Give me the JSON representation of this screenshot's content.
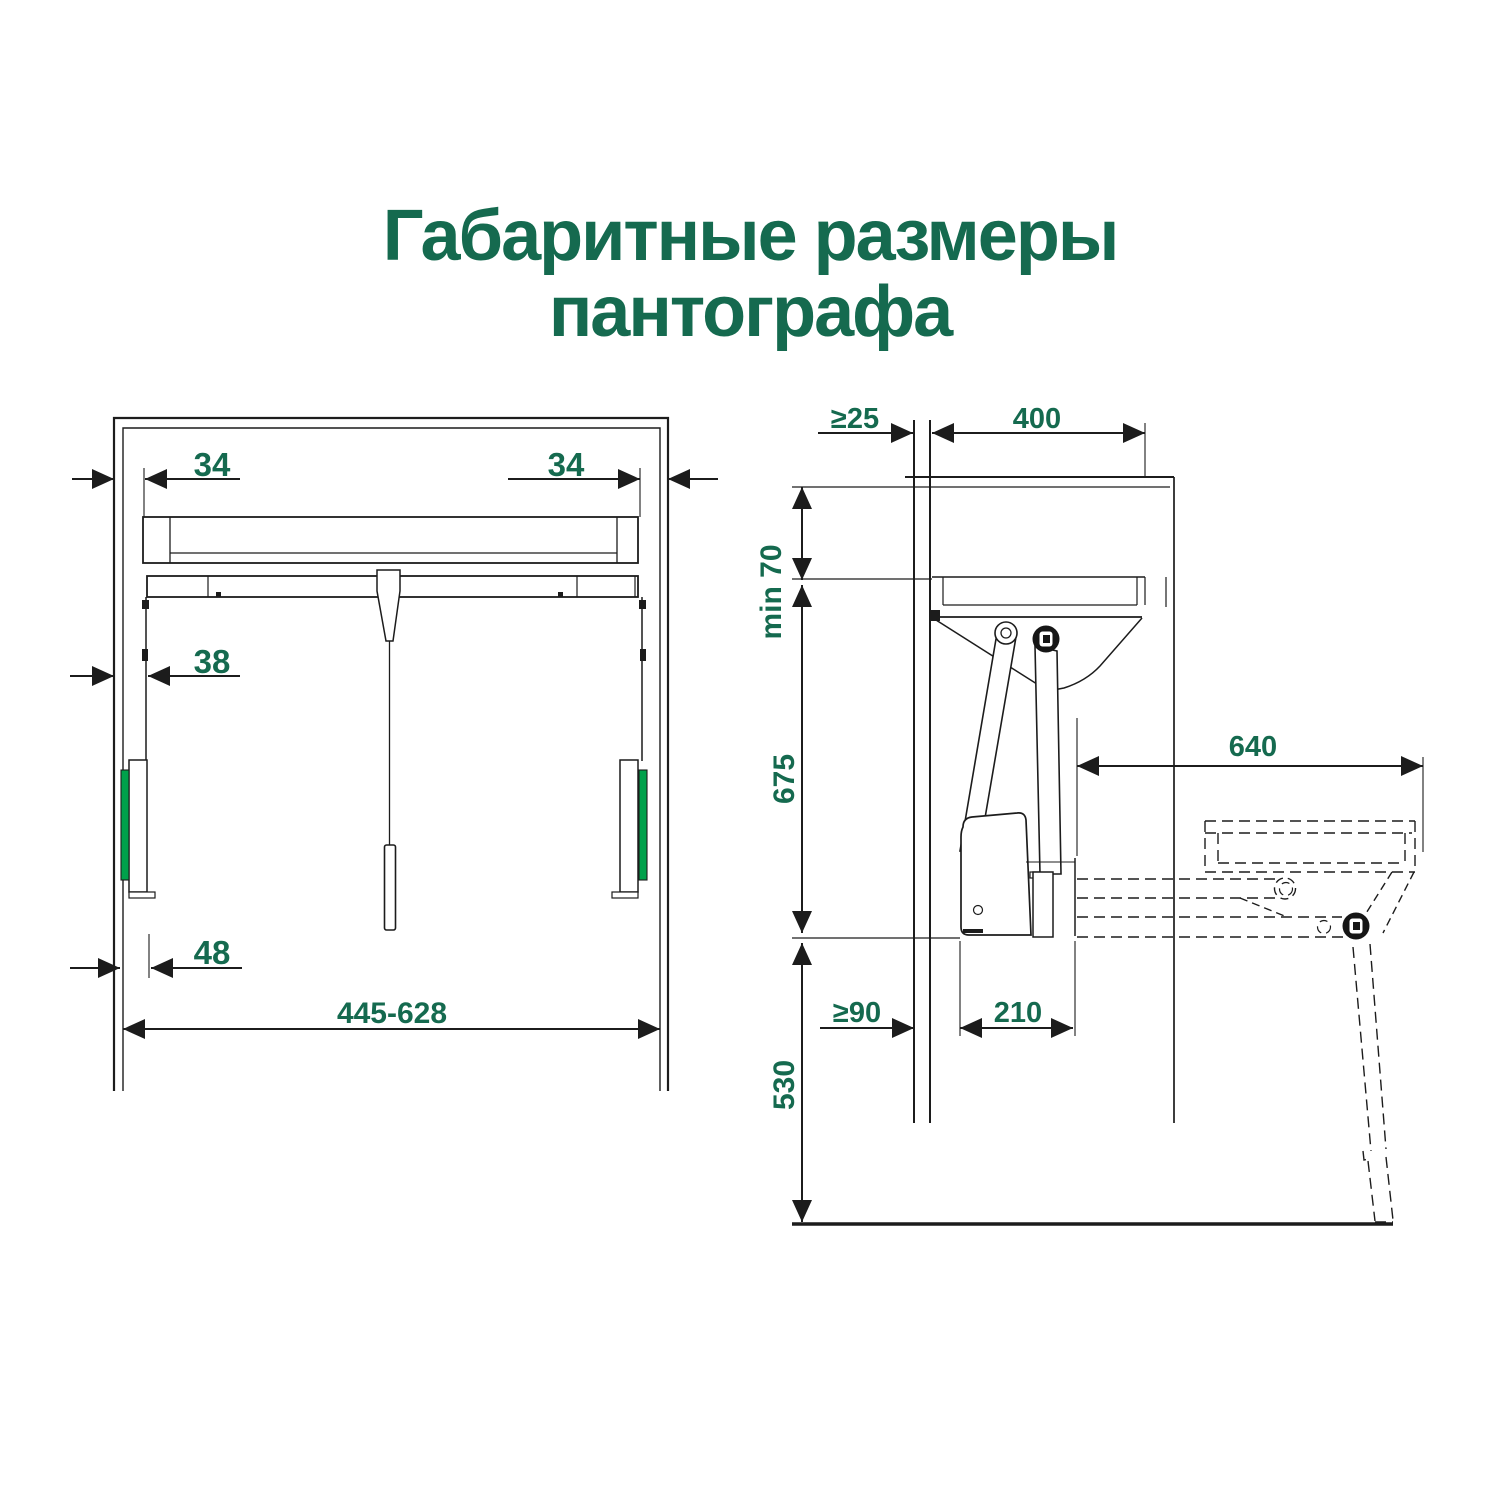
{
  "title": {
    "line1": "Габаритные размеры",
    "line2": "пантографа"
  },
  "colors": {
    "title_text": "#156a4f",
    "dimension_text": "#156a4f",
    "accent_green": "#00a14b",
    "line": "#1c1c1c"
  },
  "front_view": {
    "dims": {
      "offset_left": "34",
      "offset_right": "34",
      "rail_inset": "38",
      "slider_inset": "48",
      "width_range": "445-628"
    }
  },
  "side_view": {
    "dims": {
      "back_gap": "≥25",
      "inner_depth": "400",
      "top_clearance": "min 70",
      "mechanism_height": "675",
      "extension_reach": "640",
      "wall_gap": "≥90",
      "mechanism_depth": "210",
      "drop_height": "530"
    }
  }
}
